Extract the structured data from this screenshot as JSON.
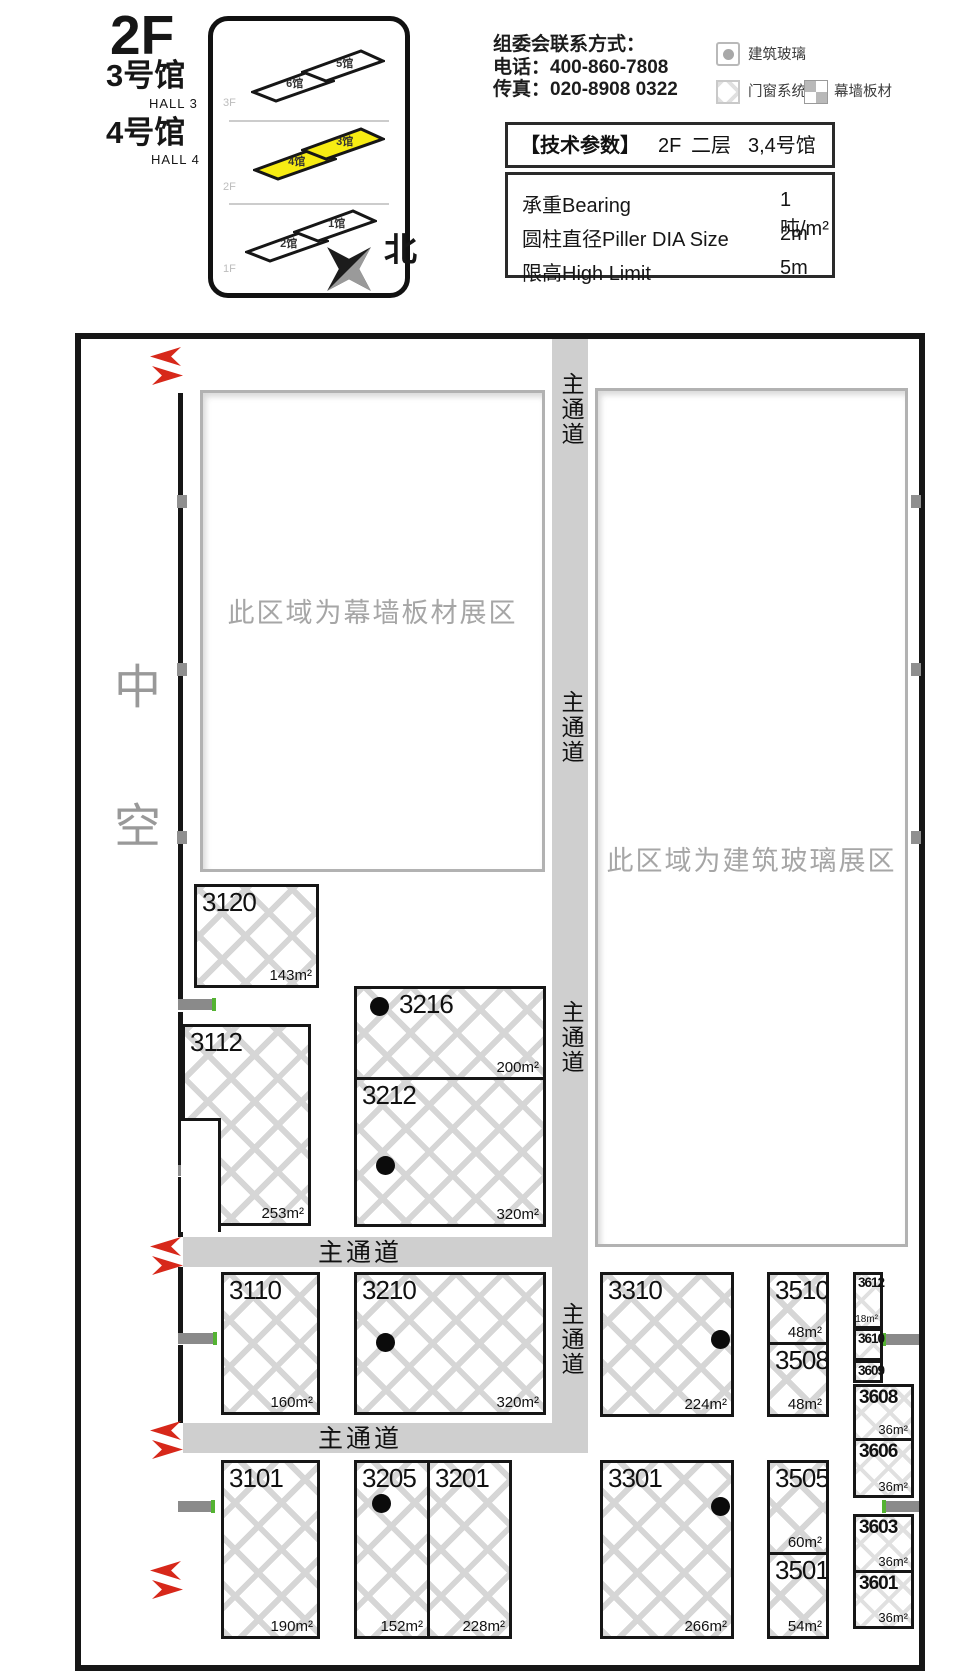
{
  "header": {
    "floor": "2F",
    "halls": [
      {
        "cn": "3号馆",
        "en": "HALL 3"
      },
      {
        "cn": "4号馆",
        "en": "HALL 4"
      }
    ],
    "north": "北",
    "contact": {
      "line1": "组委会联系方式：",
      "line2": "电话：400-860-7808",
      "line3": "传真：020-8908 0322"
    },
    "legend": [
      {
        "label": "建筑玻璃"
      },
      {
        "label": "门窗系统"
      },
      {
        "label": "幕墙板材"
      }
    ],
    "minimap": {
      "floors": [
        {
          "label": "3F",
          "halls": [
            "6馆",
            "5馆"
          ]
        },
        {
          "label": "2F",
          "halls": [
            "4馆",
            "3馆"
          ]
        },
        {
          "label": "1F",
          "halls": [
            "2馆",
            "1馆"
          ]
        }
      ],
      "highlight_color": "#f7ec13"
    },
    "tech": {
      "title": "【技术参数】",
      "floor": "2F",
      "floor_cn": "二层",
      "halls": "3,4号馆",
      "rows": [
        {
          "label": "承重Bearing",
          "value": "1吨/m²"
        },
        {
          "label": "圆柱直径Piller DIA Size",
          "value": "2m"
        },
        {
          "label": "限高High Limit",
          "value": "5m"
        }
      ]
    }
  },
  "plan": {
    "atrium": "中空",
    "aisle_label": "主通道",
    "areas": [
      {
        "label": "此区域为幕墙板材展区"
      },
      {
        "label": "此区域为建筑玻璃展区"
      }
    ],
    "booths": [
      {
        "id": "3120",
        "size": "143m²"
      },
      {
        "id": "3112",
        "size": "253m²"
      },
      {
        "id": "3216",
        "size": "200m²",
        "glass_dot": true
      },
      {
        "id": "3212",
        "size": "320m²",
        "glass_dot": true
      },
      {
        "id": "3110",
        "size": "160m²"
      },
      {
        "id": "3210",
        "size": "320m²",
        "glass_dot": true
      },
      {
        "id": "3310",
        "size": "224m²",
        "glass_dot": true
      },
      {
        "id": "3510",
        "size": "48m²"
      },
      {
        "id": "3508",
        "size": "48m²"
      },
      {
        "id": "3612",
        "size": "18m²"
      },
      {
        "id": "3610",
        "size": ""
      },
      {
        "id": "3609",
        "size": ""
      },
      {
        "id": "3608",
        "size": "36m²"
      },
      {
        "id": "3606",
        "size": "36m²"
      },
      {
        "id": "3101",
        "size": "190m²"
      },
      {
        "id": "3205",
        "size": "152m²",
        "glass_dot": true
      },
      {
        "id": "3201",
        "size": "228m²"
      },
      {
        "id": "3301",
        "size": "266m²",
        "glass_dot": true
      },
      {
        "id": "3505",
        "size": "60m²"
      },
      {
        "id": "3501",
        "size": "54m²"
      },
      {
        "id": "3603",
        "size": "36m²"
      },
      {
        "id": "3601",
        "size": "36m²"
      }
    ],
    "colors": {
      "corridor": "#cfcfcf",
      "entrance_arrow": "#d7281a",
      "door_bar": "#8a8a8a",
      "door_tick": "#54b332"
    }
  }
}
